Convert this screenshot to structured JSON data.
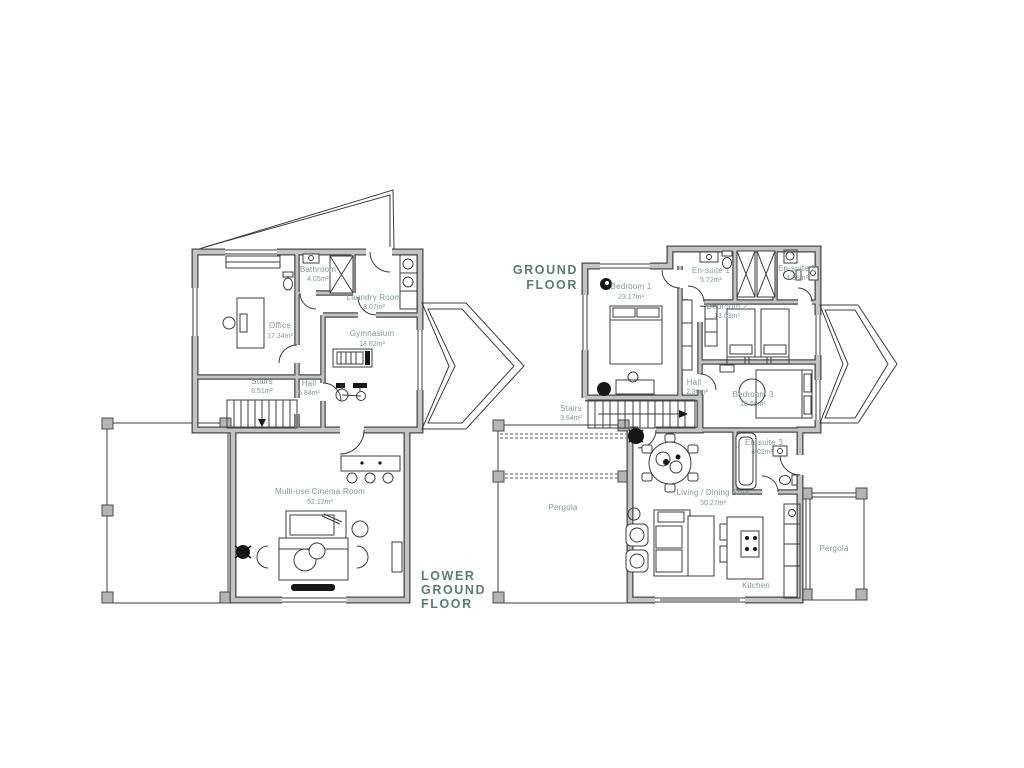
{
  "document": {
    "type": "architectural-floor-plan"
  },
  "colors": {
    "background": "#ffffff",
    "wall_core": "#c3c3c3",
    "wall_edge": "#4a4a4a",
    "line": "#3c3c3c",
    "room_label": "#7d9a9a",
    "floor_title": "#56806d",
    "plant": "#161616"
  },
  "floors": [
    {
      "id": "lower-ground-floor",
      "title_lines": [
        "LOWER",
        "GROUND",
        "FLOOR"
      ],
      "rooms": [
        {
          "name": "Office",
          "area": "17.34m²"
        },
        {
          "name": "Bathroom",
          "area": "4.05m²"
        },
        {
          "name": "Laundry Room",
          "area": "8.07m²"
        },
        {
          "name": "Gymnasium",
          "area": "18.62m²"
        },
        {
          "name": "Stairs",
          "area": "8.51m²"
        },
        {
          "name": "Hall",
          "area": "5.84m²"
        },
        {
          "name": "Multi-use Cinema Room",
          "area": "52.12m²"
        }
      ]
    },
    {
      "id": "ground-floor",
      "title_lines": [
        "GROUND",
        "FLOOR"
      ],
      "rooms": [
        {
          "name": "Bedroom 1",
          "area": "23.17m²"
        },
        {
          "name": "En-suite 1",
          "area": "5.72m²"
        },
        {
          "name": "En-suite 2",
          "area": "4.68m²"
        },
        {
          "name": "Bedroom 2",
          "area": "13.63m²"
        },
        {
          "name": "Hall",
          "area": "2.80m²"
        },
        {
          "name": "Bedroom 3",
          "area": "10.68m²"
        },
        {
          "name": "En-suite 3",
          "area": "4.02m²"
        },
        {
          "name": "Stairs",
          "area": "3.64m²"
        },
        {
          "name": "Living / Dining Area",
          "area": "50.27m²"
        },
        {
          "name": "Kitchen",
          "area": ""
        },
        {
          "name": "Pergola",
          "area": ""
        },
        {
          "name": "Pergola",
          "area": ""
        }
      ]
    }
  ]
}
